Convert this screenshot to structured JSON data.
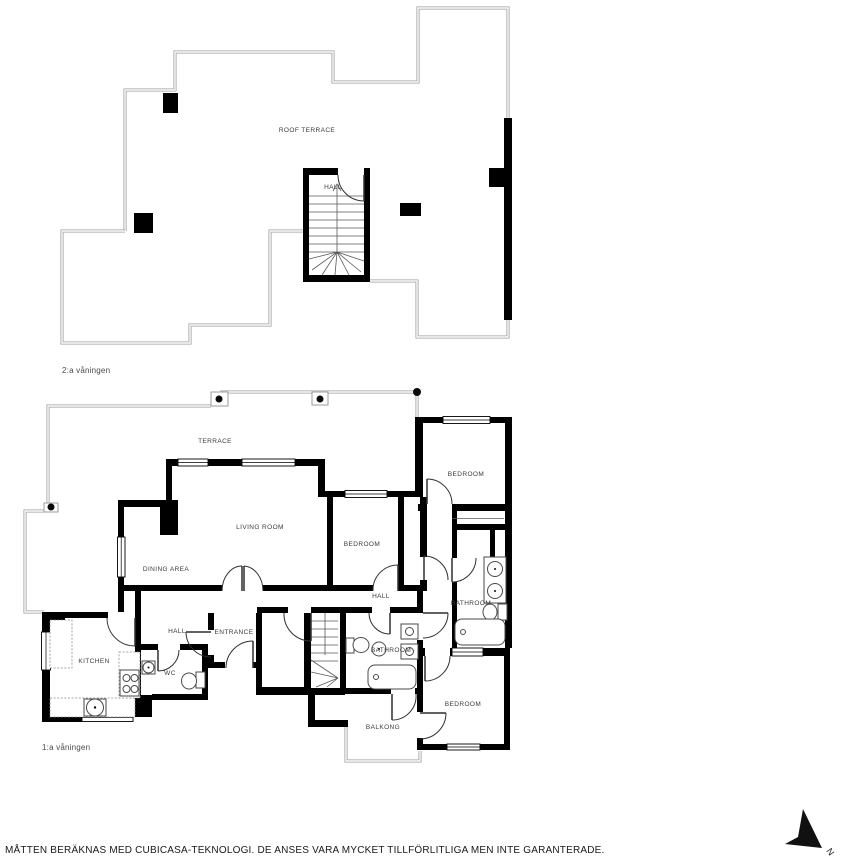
{
  "floor2": {
    "floor_label": "2:a våningen",
    "rooms": {
      "roof_terrace": "ROOF TERRACE",
      "hall": "HALL"
    }
  },
  "floor1": {
    "floor_label": "1:a våningen",
    "rooms": {
      "terrace": "TERRACE",
      "living_room": "LIVING ROOM",
      "dining_area": "DINING AREA",
      "bedroom_middle": "BEDROOM",
      "bedroom_top_right": "BEDROOM",
      "bedroom_bottom_right": "BEDROOM",
      "bathroom_right": "BATHROOM",
      "bathroom_middle": "BATHROOM",
      "hall_middle": "HALL",
      "hall_left": "HALL",
      "entrance": "ENTRANCE",
      "kitchen": "KITCHEN",
      "wc": "WC",
      "balkong": "BALKONG"
    }
  },
  "compass": {
    "label": "N"
  },
  "footer": {
    "disclaimer": "MÅTTEN BERÄKNAS MED CUBICASA-TEKNOLOGI. DE ANSES VARA MYCKET TILLFÖRLITLIGA MEN INTE GARANTERADE."
  },
  "colors": {
    "wall": "#000000",
    "railing": "#9b9b9b",
    "label_text": "#3a3a3a"
  }
}
